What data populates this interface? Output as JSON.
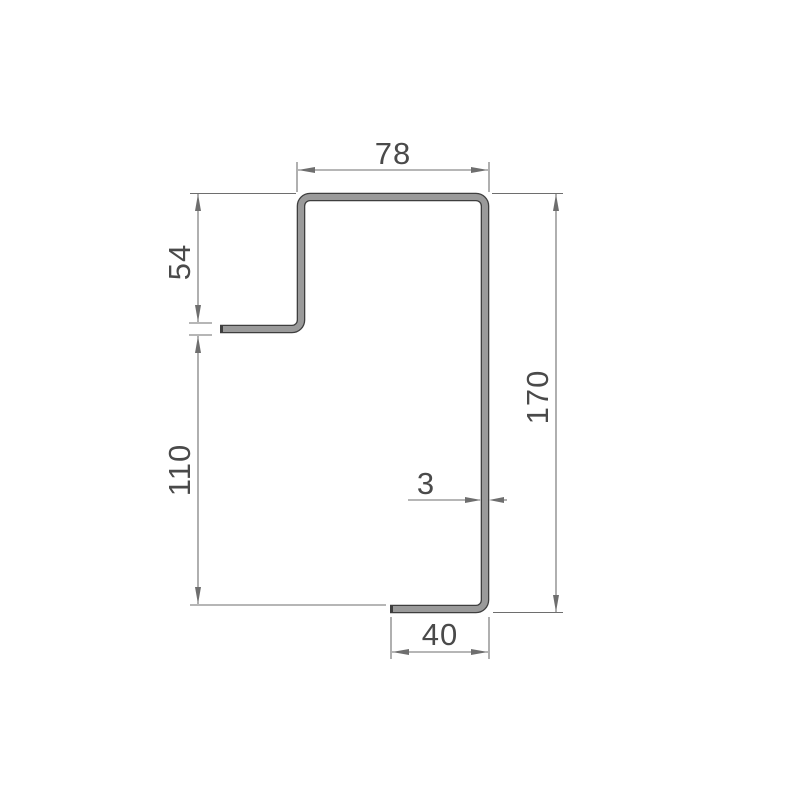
{
  "drawing": {
    "kind": "sheet-metal-profile-cross-section",
    "dimensions": {
      "top_width": "78",
      "upper_left_height": "54",
      "lower_left_height": "110",
      "right_height": "170",
      "thickness": "3",
      "bottom_width": "40"
    },
    "colors": {
      "background": "#ffffff",
      "profile_fill": "#9a9a9a",
      "profile_outline": "#3e3e3e",
      "dimension_lines": "#6e6e6e",
      "dimension_text": "#4a4a4a"
    }
  }
}
